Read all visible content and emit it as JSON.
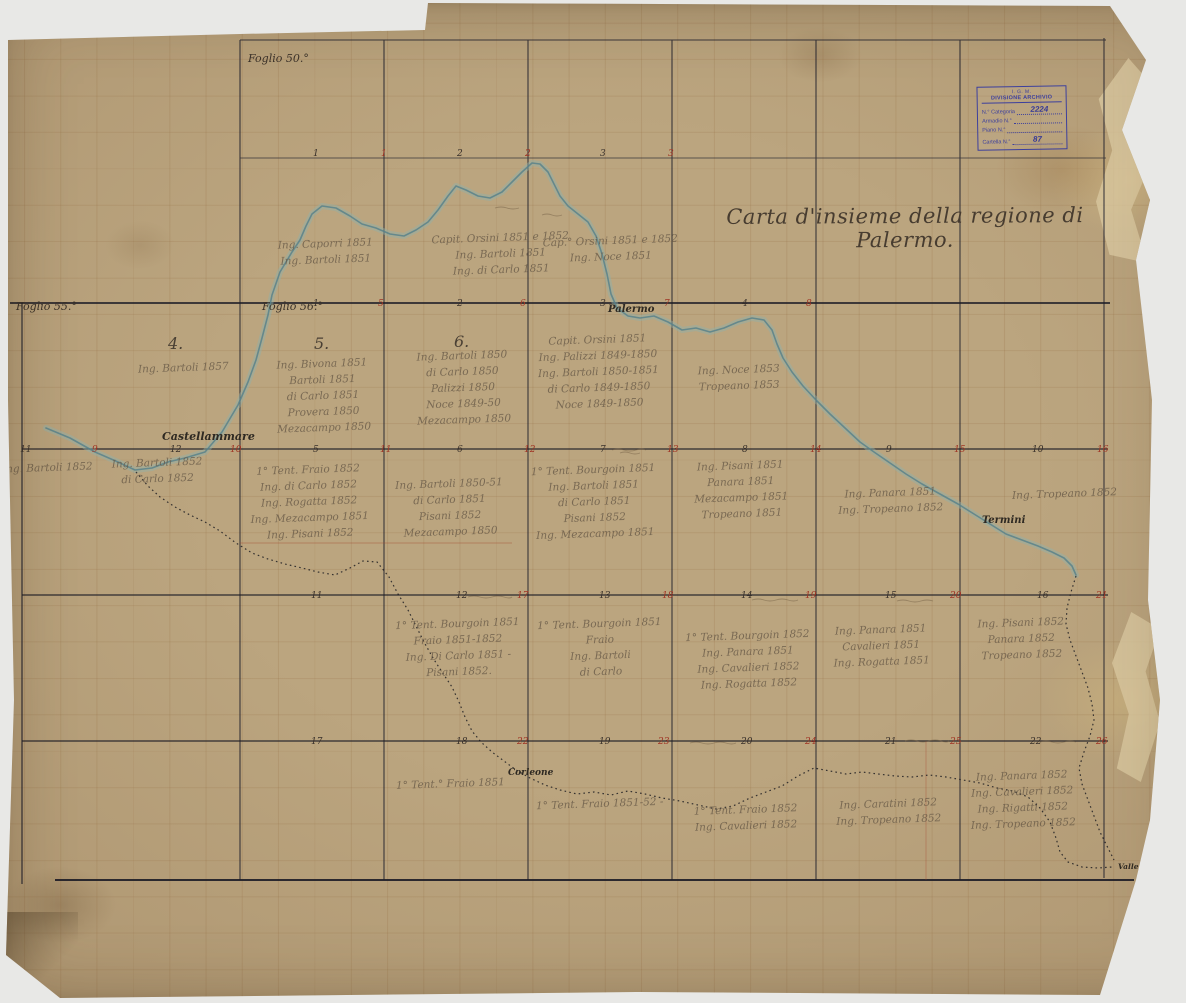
{
  "map": {
    "title": "Carta d'insieme della regione di Palermo.",
    "sheet_labels": [
      {
        "text": "Foglio 50.°",
        "x": 248,
        "y": 52
      },
      {
        "text": "Foglio 55.°",
        "x": 16,
        "y": 300
      },
      {
        "text": "Foglio 56.°",
        "x": 262,
        "y": 300
      }
    ],
    "place_labels": [
      {
        "text": "Castellammare",
        "x": 162,
        "y": 430,
        "size": 11
      },
      {
        "text": "Palermo",
        "x": 608,
        "y": 304
      },
      {
        "text": "Termini",
        "x": 982,
        "y": 515
      },
      {
        "text": "Corleone",
        "x": 508,
        "y": 768,
        "size": 9
      },
      {
        "text": "Valle dell'Oreto",
        "x": 1118,
        "y": 862,
        "size": 7.5
      }
    ],
    "quadrant_numbers": [
      {
        "text": "4.",
        "x": 168,
        "y": 334
      },
      {
        "text": "5.",
        "x": 314,
        "y": 334
      },
      {
        "text": "6.",
        "x": 454,
        "y": 332
      }
    ],
    "grid_numbers_black": [
      {
        "text": "1",
        "x": 313,
        "y": 149
      },
      {
        "text": "2",
        "x": 457,
        "y": 149
      },
      {
        "text": "3",
        "x": 600,
        "y": 149
      },
      {
        "text": "1",
        "x": 313,
        "y": 299
      },
      {
        "text": "2",
        "x": 457,
        "y": 299
      },
      {
        "text": "3",
        "x": 600,
        "y": 299
      },
      {
        "text": "4",
        "x": 742,
        "y": 299
      },
      {
        "text": "11",
        "x": 20,
        "y": 445
      },
      {
        "text": "12",
        "x": 170,
        "y": 445
      },
      {
        "text": "5",
        "x": 313,
        "y": 445
      },
      {
        "text": "6",
        "x": 457,
        "y": 445
      },
      {
        "text": "7",
        "x": 600,
        "y": 445
      },
      {
        "text": "8",
        "x": 742,
        "y": 445
      },
      {
        "text": "9",
        "x": 886,
        "y": 445
      },
      {
        "text": "10",
        "x": 1032,
        "y": 445
      },
      {
        "text": "11",
        "x": 311,
        "y": 591
      },
      {
        "text": "12",
        "x": 456,
        "y": 591
      },
      {
        "text": "13",
        "x": 599,
        "y": 591
      },
      {
        "text": "14",
        "x": 741,
        "y": 591
      },
      {
        "text": "15",
        "x": 885,
        "y": 591
      },
      {
        "text": "16",
        "x": 1037,
        "y": 591
      },
      {
        "text": "17",
        "x": 311,
        "y": 737
      },
      {
        "text": "18",
        "x": 456,
        "y": 737
      },
      {
        "text": "19",
        "x": 599,
        "y": 737
      },
      {
        "text": "20",
        "x": 741,
        "y": 737
      },
      {
        "text": "21",
        "x": 885,
        "y": 737
      },
      {
        "text": "22",
        "x": 1030,
        "y": 737
      }
    ],
    "grid_numbers_red": [
      {
        "text": "1",
        "x": 381,
        "y": 149
      },
      {
        "text": "2",
        "x": 525,
        "y": 149
      },
      {
        "text": "3",
        "x": 668,
        "y": 149
      },
      {
        "text": "5",
        "x": 378,
        "y": 299
      },
      {
        "text": "6",
        "x": 520,
        "y": 299
      },
      {
        "text": "7",
        "x": 664,
        "y": 299
      },
      {
        "text": "8",
        "x": 806,
        "y": 299
      },
      {
        "text": "9",
        "x": 92,
        "y": 445
      },
      {
        "text": "10",
        "x": 230,
        "y": 445
      },
      {
        "text": "11",
        "x": 380,
        "y": 445
      },
      {
        "text": "12",
        "x": 524,
        "y": 445
      },
      {
        "text": "13",
        "x": 667,
        "y": 445
      },
      {
        "text": "14",
        "x": 810,
        "y": 445
      },
      {
        "text": "15",
        "x": 954,
        "y": 445
      },
      {
        "text": "16",
        "x": 1097,
        "y": 445
      },
      {
        "text": "17",
        "x": 517,
        "y": 591
      },
      {
        "text": "18",
        "x": 662,
        "y": 591
      },
      {
        "text": "19",
        "x": 805,
        "y": 591
      },
      {
        "text": "20",
        "x": 950,
        "y": 591
      },
      {
        "text": "21",
        "x": 1096,
        "y": 591
      },
      {
        "text": "22",
        "x": 517,
        "y": 737
      },
      {
        "text": "23",
        "x": 658,
        "y": 737
      },
      {
        "text": "24",
        "x": 805,
        "y": 737
      },
      {
        "text": "25",
        "x": 950,
        "y": 737
      },
      {
        "text": "26",
        "x": 1096,
        "y": 737
      }
    ],
    "annotations": [
      {
        "x": 278,
        "y": 236,
        "lines": [
          "Ing. Caporri 1851",
          "Ing. Bartoli 1851"
        ]
      },
      {
        "x": 432,
        "y": 230,
        "lines": [
          "Capit. Orsini 1851 e 1852",
          "Ing. Bartoli 1851",
          "Ing. di Carlo 1851"
        ]
      },
      {
        "x": 543,
        "y": 233,
        "lines": [
          "Cap.° Orsini 1851 e 1852",
          "Ing. Noce 1851"
        ]
      },
      {
        "x": 138,
        "y": 360,
        "lines": [
          "Ing. Bartoli 1857"
        ]
      },
      {
        "x": 276,
        "y": 356,
        "lines": [
          "Ing. Bivona 1851",
          "Bartoli 1851",
          "di Carlo 1851",
          "Provera 1850",
          "Mezacampo 1850"
        ]
      },
      {
        "x": 416,
        "y": 348,
        "lines": [
          "Ing. Bartoli 1850",
          "di Carlo 1850",
          "Palizzi 1850",
          "Noce 1849-50",
          "Mezacampo 1850"
        ]
      },
      {
        "x": 538,
        "y": 332,
        "lines": [
          "Capit. Orsini 1851",
          "Ing. Palizzi 1849-1850",
          "Ing. Bartoli 1850-1851",
          "di Carlo 1849-1850",
          "Noce 1849-1850"
        ]
      },
      {
        "x": 698,
        "y": 362,
        "lines": [
          "Ing. Noce 1853",
          "Tropeano 1853"
        ]
      },
      {
        "x": 2,
        "y": 460,
        "lines": [
          "Ing. Bartoli 1852"
        ]
      },
      {
        "x": 112,
        "y": 455,
        "lines": [
          "Ing. Bartoli 1852",
          "di Carlo 1852"
        ]
      },
      {
        "x": 250,
        "y": 462,
        "lines": [
          "1° Tent. Fraio 1852",
          "Ing. di Carlo 1852",
          "Ing. Rogatta 1852",
          "Ing. Mezacampo 1851",
          "Ing. Pisani 1852"
        ]
      },
      {
        "x": 396,
        "y": 476,
        "lines": [
          "Ing. Bartoli 1850-51",
          "di Carlo 1851",
          "Pisani 1852",
          "Mezacampo 1850"
        ]
      },
      {
        "x": 532,
        "y": 462,
        "lines": [
          "1° Tent. Bourgoin 1851",
          "Ing. Bartoli 1851",
          "di Carlo 1851",
          "Pisani 1852",
          "Ing. Mezacampo 1851"
        ]
      },
      {
        "x": 694,
        "y": 458,
        "lines": [
          "Ing. Pisani 1851",
          "Panara 1851",
          "Mezacampo 1851",
          "Tropeano 1851"
        ]
      },
      {
        "x": 838,
        "y": 485,
        "lines": [
          "Ing. Panara 1851",
          "Ing. Tropeano 1852"
        ]
      },
      {
        "x": 1012,
        "y": 486,
        "lines": [
          "Ing. Tropeano 1852"
        ]
      },
      {
        "x": 396,
        "y": 616,
        "lines": [
          "1° Tent. Bourgoin 1851",
          "Fraio 1851-1852",
          "Ing. Di Carlo 1851 -",
          "Pisani 1852."
        ]
      },
      {
        "x": 538,
        "y": 616,
        "lines": [
          "1° Tent. Bourgoin 1851",
          "Fraio",
          "Ing. Bartoli",
          "di Carlo"
        ]
      },
      {
        "x": 686,
        "y": 628,
        "lines": [
          "1° Tent. Bourgoin 1852",
          "Ing. Panara 1851",
          "Ing. Cavalieri 1852",
          "Ing. Rogatta 1852"
        ]
      },
      {
        "x": 833,
        "y": 622,
        "lines": [
          "Ing. Panara 1851",
          "Cavalieri 1851",
          "Ing. Rogatta 1851"
        ]
      },
      {
        "x": 978,
        "y": 615,
        "lines": [
          "Ing. Pisani 1852",
          "Panara 1852",
          "Tropeano 1852"
        ]
      },
      {
        "x": 396,
        "y": 776,
        "lines": [
          "1° Tent.° Fraio 1851"
        ]
      },
      {
        "x": 536,
        "y": 796,
        "lines": [
          "1° Tent. Fraio 1851-52 -"
        ]
      },
      {
        "x": 694,
        "y": 802,
        "lines": [
          "1° Tent. Fraio 1852",
          "Ing. Cavalieri 1852"
        ]
      },
      {
        "x": 836,
        "y": 796,
        "lines": [
          "Ing. Caratini 1852",
          "Ing. Tropeano 1852"
        ]
      },
      {
        "x": 970,
        "y": 768,
        "lines": [
          "Ing. Panara 1852",
          "Ing. Cavalieri 1852",
          "Ing. Rigatti 1852",
          "Ing. Tropeano 1852"
        ]
      }
    ]
  },
  "stamp": {
    "header1": "I. G. M.",
    "header2": "DIVISIONE ARCHIVIO",
    "rows": [
      {
        "label": "N.° Categoria",
        "value": "2224"
      },
      {
        "label": "Armadio N.°",
        "value": ""
      },
      {
        "label": "Piano N.°",
        "value": ""
      },
      {
        "label": "Cartella N.°",
        "value": "87"
      }
    ]
  },
  "colors": {
    "paper": "#b49c77",
    "grid_ink": "#23232e",
    "red_ink": "#a03424",
    "coast_wash": "#8fb2ae",
    "stamp_ink": "#3c3f9d"
  }
}
